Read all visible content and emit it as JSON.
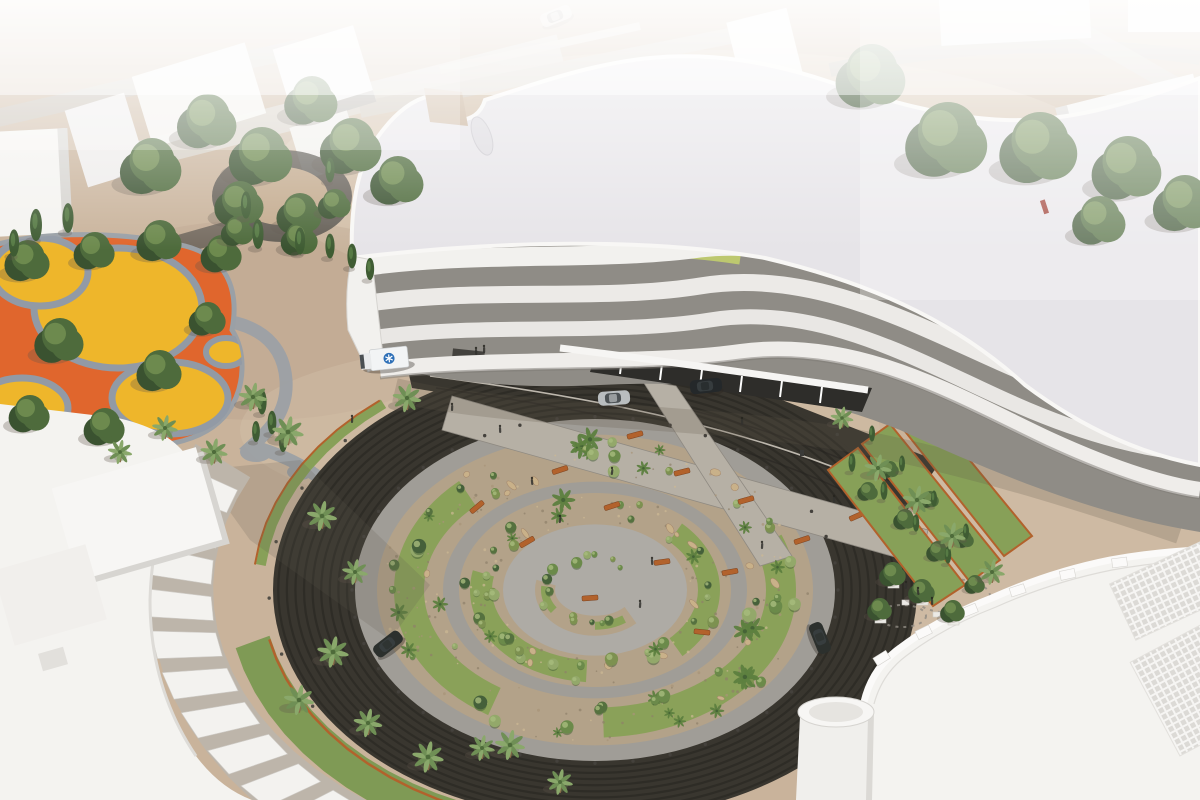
{
  "scene": {
    "type": "architectural-aerial-rendering",
    "description": "Aerial 3D rendering of a curvilinear white hospital building with wavy facade bands, a large circular landscaped drop-off plaza with concentric garden rings and dark ring road, palm trees, an ambulance at the entry and cars on the ring road, surrounded by white campus buildings and a colorful playground",
    "palette": {
      "sand": "#c9b39b",
      "sand_light": "#d8c6b0",
      "sand_deep": "#b8a189",
      "haze": "#edeae5",
      "road": "#c2bcb2",
      "white1": "#f4f3f0",
      "white2": "#e9e7e4",
      "shade": "#d6d4d0",
      "roof": "#e6e4e8",
      "glaze": "#8f8c86",
      "glaze_dark": "#44423e",
      "green_glass": "#c2ce6d",
      "ring_dark": "#39362f",
      "ring_stripe": "#23211e",
      "path1": "#a09d97",
      "path2": "#b6b0a5",
      "gravel": "#b3a289",
      "grass": "#8aa159",
      "grass_deep": "#7f9a55",
      "tree": "#4e6b3c",
      "tree_dark": "#3a5230",
      "tree_lite": "#6d8a4e",
      "palm": "#6f8f55",
      "palm_lite": "#8aa86b",
      "cypress": "#3f5c33",
      "corten": "#b2622c",
      "play_orange": "#e0662d",
      "play_yellow": "#eeb62b",
      "play_path": "#929aa5",
      "rock": "#c9b189",
      "bollard": "#44413c",
      "shadow": "#5f574b",
      "amb_white": "#f2f4f5",
      "amb_blue": "#2d6fb7",
      "car_silver": "#b9bdbf",
      "car_dark": "#24282a"
    },
    "shrub_colors": [
      "#7d9150",
      "#55713f",
      "#93a86a",
      "#45603a",
      "#6b8a4a"
    ],
    "vehicles": [
      {
        "kind": "ambulance",
        "body": "#f2f4f5",
        "emblem": "#2d6fb7"
      },
      {
        "kind": "sedan-silver",
        "body": "#b9bdbf"
      },
      {
        "kind": "suv-dark",
        "body": "#24282a"
      },
      {
        "kind": "sedan-dark-right",
        "body": "#2c302d"
      },
      {
        "kind": "sedan-dark-left",
        "body": "#2c302d"
      },
      {
        "kind": "sedan-faint-top",
        "body": "#e8e8e6"
      }
    ],
    "features": {
      "hospital_building": "white curvilinear multi-storey building with wavy floor bands and green glass clerestory",
      "circular_plaza": "concentric ring garden: dark striped ring road, grey walking rings, gravel and grass planting rings, corten benches",
      "playground": "orange and yellow circular soft-surface play area",
      "campus_buildings": "plain white massing models around the site"
    }
  }
}
